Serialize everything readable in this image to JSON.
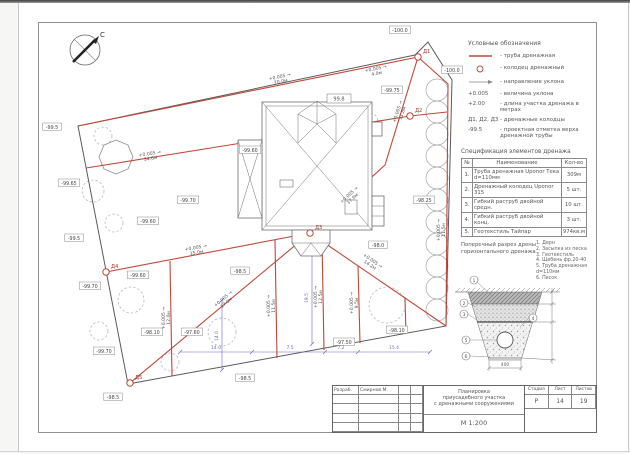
{
  "colors": {
    "drain_red": "#c04838",
    "dim_blue": "#6868c8",
    "outline": "#8a8a8a",
    "boundary": "#5a5a5a"
  },
  "plan": {
    "north_label": "С",
    "house_label": "99.8",
    "wells": [
      {
        "x": 418,
        "y": 57,
        "label": "Д1"
      },
      {
        "x": 410,
        "y": 116,
        "label": "Д2"
      },
      {
        "x": 310,
        "y": 233,
        "label": "Д3"
      },
      {
        "x": 106,
        "y": 272,
        "label": "Д4"
      },
      {
        "x": 130,
        "y": 383,
        "label": "Д5"
      }
    ],
    "elevation_labels": [
      {
        "x": 52,
        "y": 127,
        "text": "-99.5"
      },
      {
        "x": 400,
        "y": 30,
        "text": "-100.0"
      },
      {
        "x": 452,
        "y": 70,
        "text": "-100.0"
      },
      {
        "x": 392,
        "y": 90,
        "text": "-99.75"
      },
      {
        "x": 424,
        "y": 200,
        "text": "-98.25"
      },
      {
        "x": 250,
        "y": 150,
        "text": "-99.60"
      },
      {
        "x": 188,
        "y": 200,
        "text": "-99.70"
      },
      {
        "x": 148,
        "y": 221,
        "text": "-99.60"
      },
      {
        "x": 69,
        "y": 183,
        "text": "-99.65"
      },
      {
        "x": 74,
        "y": 238,
        "text": "-99.5"
      },
      {
        "x": 90,
        "y": 286,
        "text": "-99.70"
      },
      {
        "x": 138,
        "y": 275,
        "text": "-99.60"
      },
      {
        "x": 240,
        "y": 271,
        "text": "-98.5"
      },
      {
        "x": 378,
        "y": 245,
        "text": "-98.0"
      },
      {
        "x": 152,
        "y": 332,
        "text": "-98.10"
      },
      {
        "x": 192,
        "y": 332,
        "text": "-97.60"
      },
      {
        "x": 104,
        "y": 351,
        "text": "-99.70"
      },
      {
        "x": 397,
        "y": 330,
        "text": "-98.10"
      },
      {
        "x": 344,
        "y": 342,
        "text": "-97.50"
      },
      {
        "x": 245,
        "y": 378,
        "text": "-98.5"
      },
      {
        "x": 113,
        "y": 397,
        "text": "-98.5"
      }
    ],
    "slope_labels": [
      {
        "x": 280,
        "y": 78,
        "rot": -11.5,
        "slope": "+0.005",
        "len": "70.0м"
      },
      {
        "x": 376,
        "y": 70,
        "rot": -11.5,
        "slope": "+0.005",
        "len": "4.0м"
      },
      {
        "x": 399,
        "y": 112,
        "rot": -72,
        "slope": "+0.005",
        "len": "11.8м"
      },
      {
        "x": 350,
        "y": 196,
        "rot": -43,
        "slope": "+0.005",
        "len": "17.6м"
      },
      {
        "x": 224,
        "y": 300,
        "rot": -40,
        "slope": "+0.005",
        "len": "17.0м"
      },
      {
        "x": 196,
        "y": 249,
        "rot": -10,
        "slope": "+0.005",
        "len": "15.0м"
      },
      {
        "x": 440,
        "y": 230,
        "rot": -90,
        "slope": "+0.005",
        "len": "11.5м"
      },
      {
        "x": 165,
        "y": 318,
        "rot": -90,
        "slope": "+0.005",
        "len": "12.0м"
      },
      {
        "x": 270,
        "y": 306,
        "rot": -90,
        "slope": "+0.005",
        "len": "11.5м"
      },
      {
        "x": 317,
        "y": 297,
        "rot": -90,
        "slope": "+0.005",
        "len": "12.5м"
      },
      {
        "x": 353,
        "y": 303,
        "rot": -90,
        "slope": "+0.005",
        "len": "9.5м"
      },
      {
        "x": 372,
        "y": 262,
        "rot": 34,
        "slope": "+0.005",
        "len": "14.2м"
      },
      {
        "x": 150,
        "y": 155,
        "rot": -9,
        "slope": "+0.005",
        "len": "34.0м"
      }
    ],
    "dim_labels": [
      {
        "x": 216,
        "y": 349,
        "rot": 0,
        "text": "14.0"
      },
      {
        "x": 290,
        "y": 349,
        "rot": 0,
        "text": "7.5"
      },
      {
        "x": 341,
        "y": 349,
        "rot": 0,
        "text": "7.2"
      },
      {
        "x": 394,
        "y": 349,
        "rot": 0,
        "text": "15.4"
      },
      {
        "x": 308,
        "y": 298,
        "rot": -90,
        "text": "19.5"
      },
      {
        "x": 218,
        "y": 336,
        "rot": -90,
        "text": "14.0"
      }
    ]
  },
  "legend": {
    "title": "Условные обозначения",
    "items": [
      {
        "sym": "line",
        "label": "- труба дренажная"
      },
      {
        "sym": "circle",
        "label": "- колодец дренажный"
      },
      {
        "sym": "arrow",
        "label": "- направление уклона"
      },
      {
        "sym": "text",
        "symbol_text": "+0.005",
        "label": "- величина уклона"
      },
      {
        "sym": "text",
        "symbol_text": "+2.00",
        "label": "- длина участка дренажа в метрах"
      },
      {
        "sym": "text",
        "symbol_text": "Д1, Д2, Д3",
        "label": "- дренажные колодцы"
      },
      {
        "sym": "text",
        "symbol_text": "-99.5",
        "label": "- проектная отметка верха дренажной трубы"
      }
    ]
  },
  "spec": {
    "title": "Спецификация элементов дренажа",
    "headers": [
      "№",
      "Наименование",
      "Кол-во"
    ],
    "rows": [
      {
        "num": "1.",
        "name": "Труба дренажная Uponor Тека d=110мм",
        "qty": "309м"
      },
      {
        "num": "2.",
        "name": "Дренажный колодец Uponor 315",
        "qty": "5 шт."
      },
      {
        "num": "3.",
        "name": "Гибкий раструб двойной средн.",
        "qty": "10 шт."
      },
      {
        "num": "4.",
        "name": "Гибкий раструб двойной конц.",
        "qty": "3 шт."
      },
      {
        "num": "5.",
        "name": "Геотекстиль Тайпар",
        "qty": "974кв.м"
      }
    ]
  },
  "section": {
    "title_line1": "Поперечный разрез дрены",
    "title_line2": "горизонтального дренажа",
    "notes": [
      "1. Дерн",
      "2. Засыпка из песка",
      "3. Геотекстиль",
      "4. Щебень фр.20-40",
      "5. Труба дренажная d=110мм",
      "6. Песок"
    ],
    "callouts": [
      "1",
      "2",
      "3",
      "4",
      "5",
      "6"
    ],
    "bottom_dim": "400"
  },
  "titleblock": {
    "developed_label": "Разраб.",
    "developer": "Смирнов М.",
    "project_line1": "Планировка",
    "project_line2": "приусадебного участка",
    "project_line3": "с дренажными сооружениями",
    "scale": "М 1:200",
    "stage_header": "Стадия",
    "sheet_header": "Лист",
    "sheets_header": "Листов",
    "stage": "Р",
    "sheet": "14",
    "sheets": "19"
  }
}
